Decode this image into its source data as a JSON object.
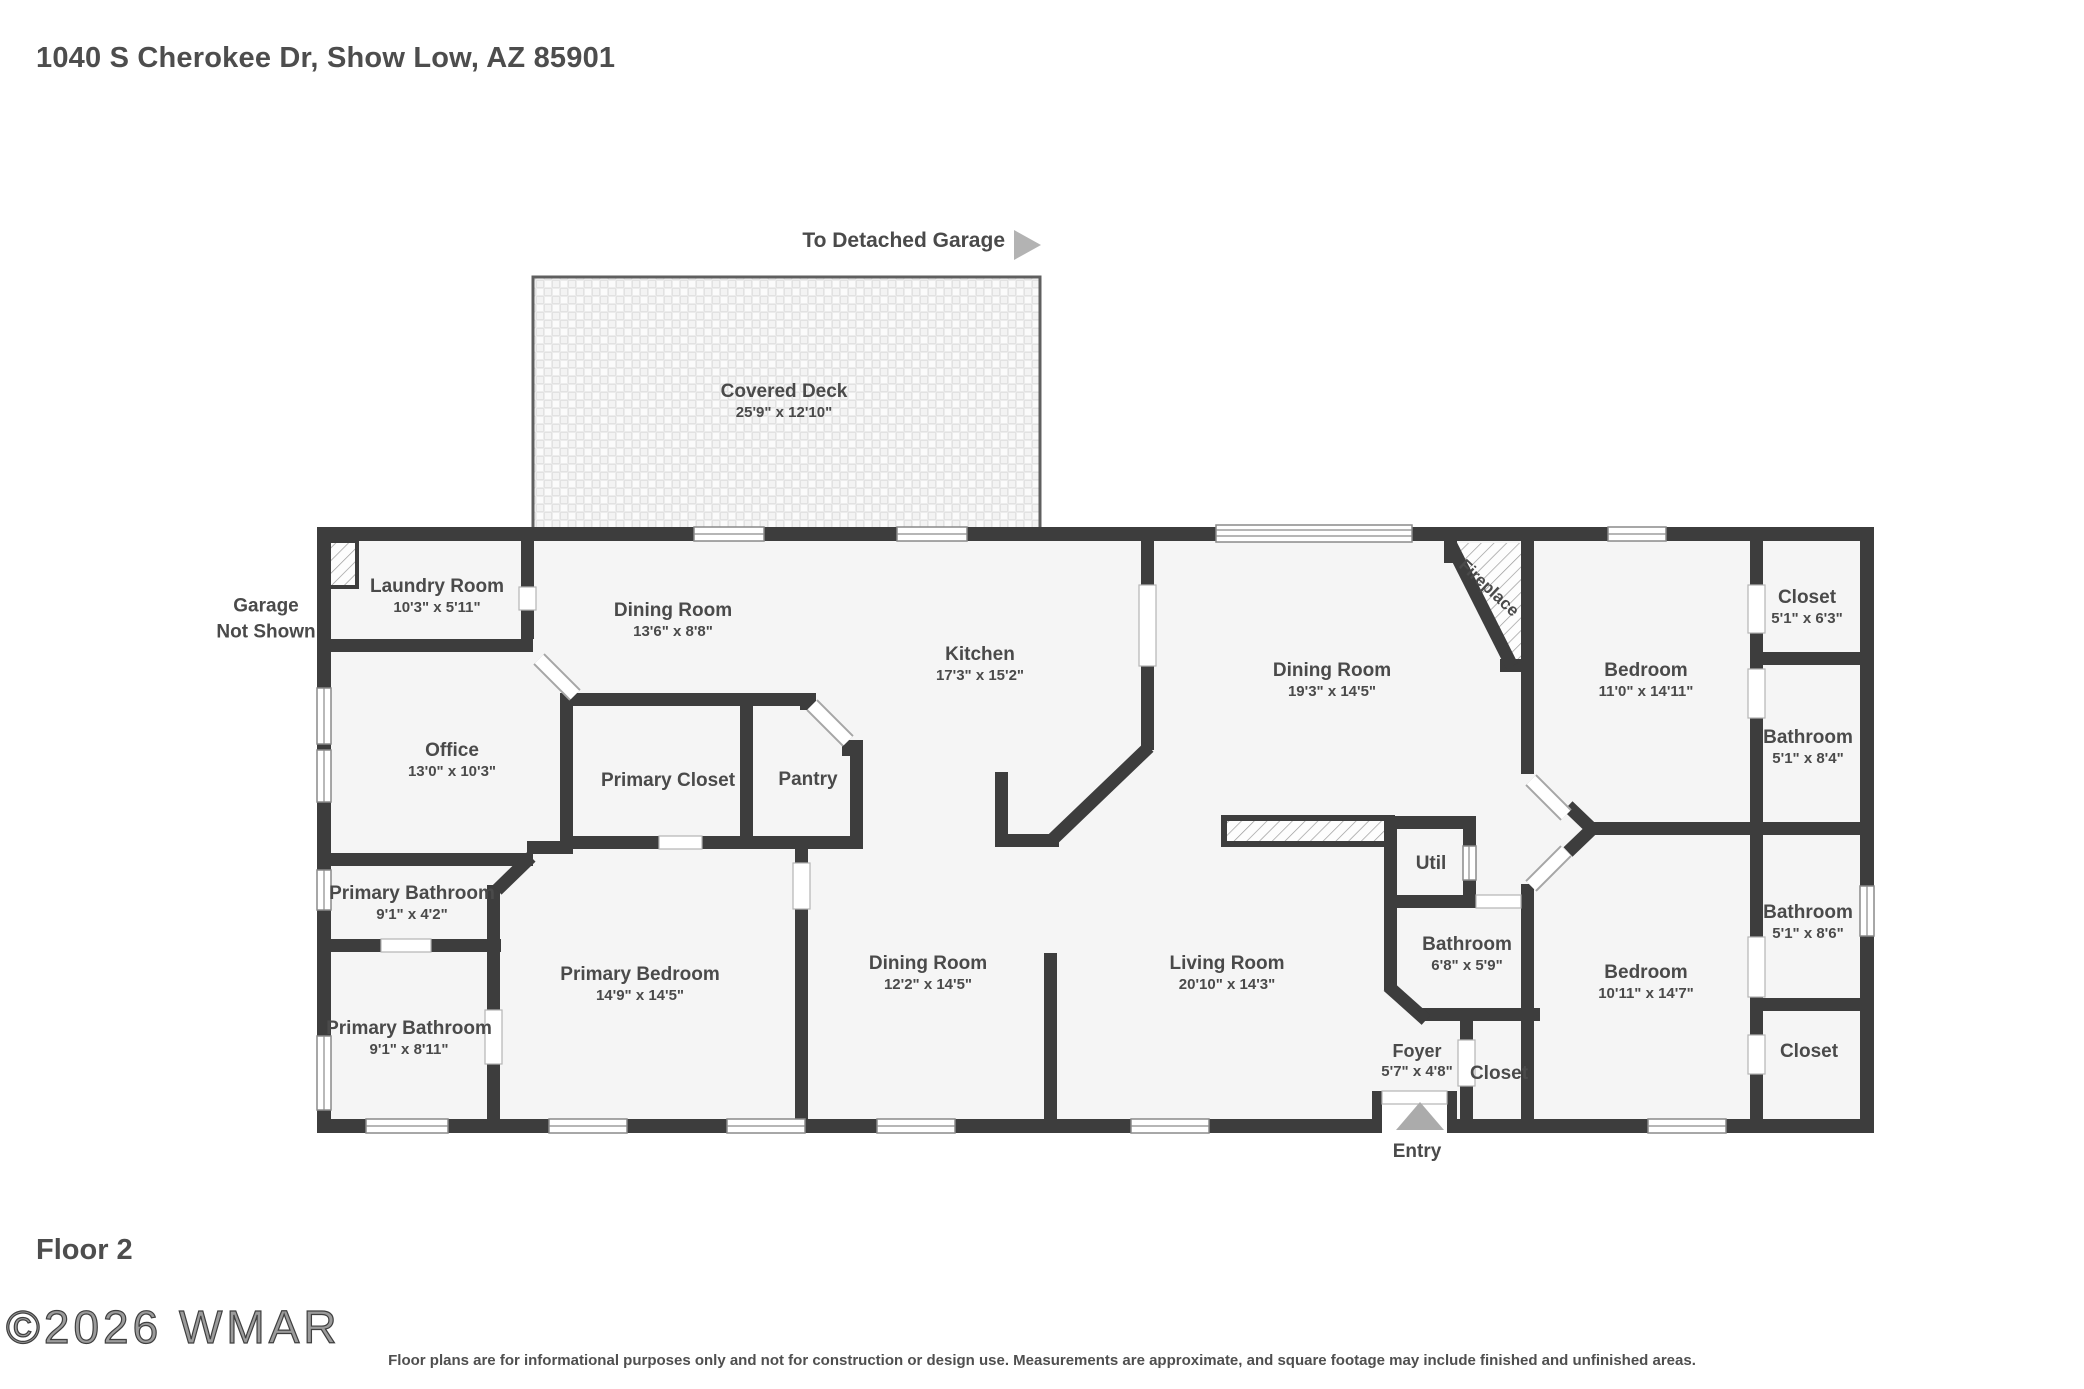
{
  "page": {
    "address_title": "1040 S Cherokee Dr, Show Low, AZ 85901",
    "floor_label": "Floor 2",
    "watermark": "©2026 WMAR",
    "disclaimer": "Floor plans are for informational purposes only and not for construction or design use. Measurements are approximate, and square footage may include finished and unfinished areas.",
    "detached_garage_note": "To Detached Garage",
    "garage_note": "Garage\nNot Shown",
    "entry_label": "Entry"
  },
  "colors": {
    "wall": "#3d3d3d",
    "room_fill": "#f5f5f5",
    "text": "#4a4a4a",
    "arrow": "#b3b3b3"
  },
  "rooms": [
    {
      "name": "Covered Deck",
      "dims": "25'9\" x 12'10\""
    },
    {
      "name": "Laundry Room",
      "dims": "10'3\" x 5'11\""
    },
    {
      "name": "Dining Room",
      "dims": "13'6\" x 8'8\""
    },
    {
      "name": "Kitchen",
      "dims": "17'3\" x 15'2\""
    },
    {
      "name": "Dining Room",
      "dims": "19'3\" x 14'5\""
    },
    {
      "name": "Bedroom",
      "dims": "11'0\" x 14'11\""
    },
    {
      "name": "Closet",
      "dims": "5'1\" x 6'3\""
    },
    {
      "name": "Bathroom",
      "dims": "5'1\" x 8'4\""
    },
    {
      "name": "Office",
      "dims": "13'0\" x 10'3\""
    },
    {
      "name": "Primary Closet",
      "dims": ""
    },
    {
      "name": "Pantry",
      "dims": ""
    },
    {
      "name": "Util",
      "dims": ""
    },
    {
      "name": "Bathroom",
      "dims": "6'8\" x 5'9\""
    },
    {
      "name": "Primary Bathroom",
      "dims": "9'1\" x 4'2\""
    },
    {
      "name": "Primary Bathroom",
      "dims": "9'1\" x 8'11\""
    },
    {
      "name": "Primary Bedroom",
      "dims": "14'9\" x 14'5\""
    },
    {
      "name": "Dining Room",
      "dims": "12'2\" x 14'5\""
    },
    {
      "name": "Living Room",
      "dims": "20'10\" x 14'3\""
    },
    {
      "name": "Bedroom",
      "dims": "10'11\" x 14'7\""
    },
    {
      "name": "Bathroom",
      "dims": "5'1\" x 8'6\""
    },
    {
      "name": "Closet",
      "dims": ""
    },
    {
      "name": "Foyer",
      "dims": "5'7\" x 4'8\""
    },
    {
      "name": "Closet",
      "dims": ""
    },
    {
      "name": "Fireplace",
      "dims": ""
    }
  ]
}
